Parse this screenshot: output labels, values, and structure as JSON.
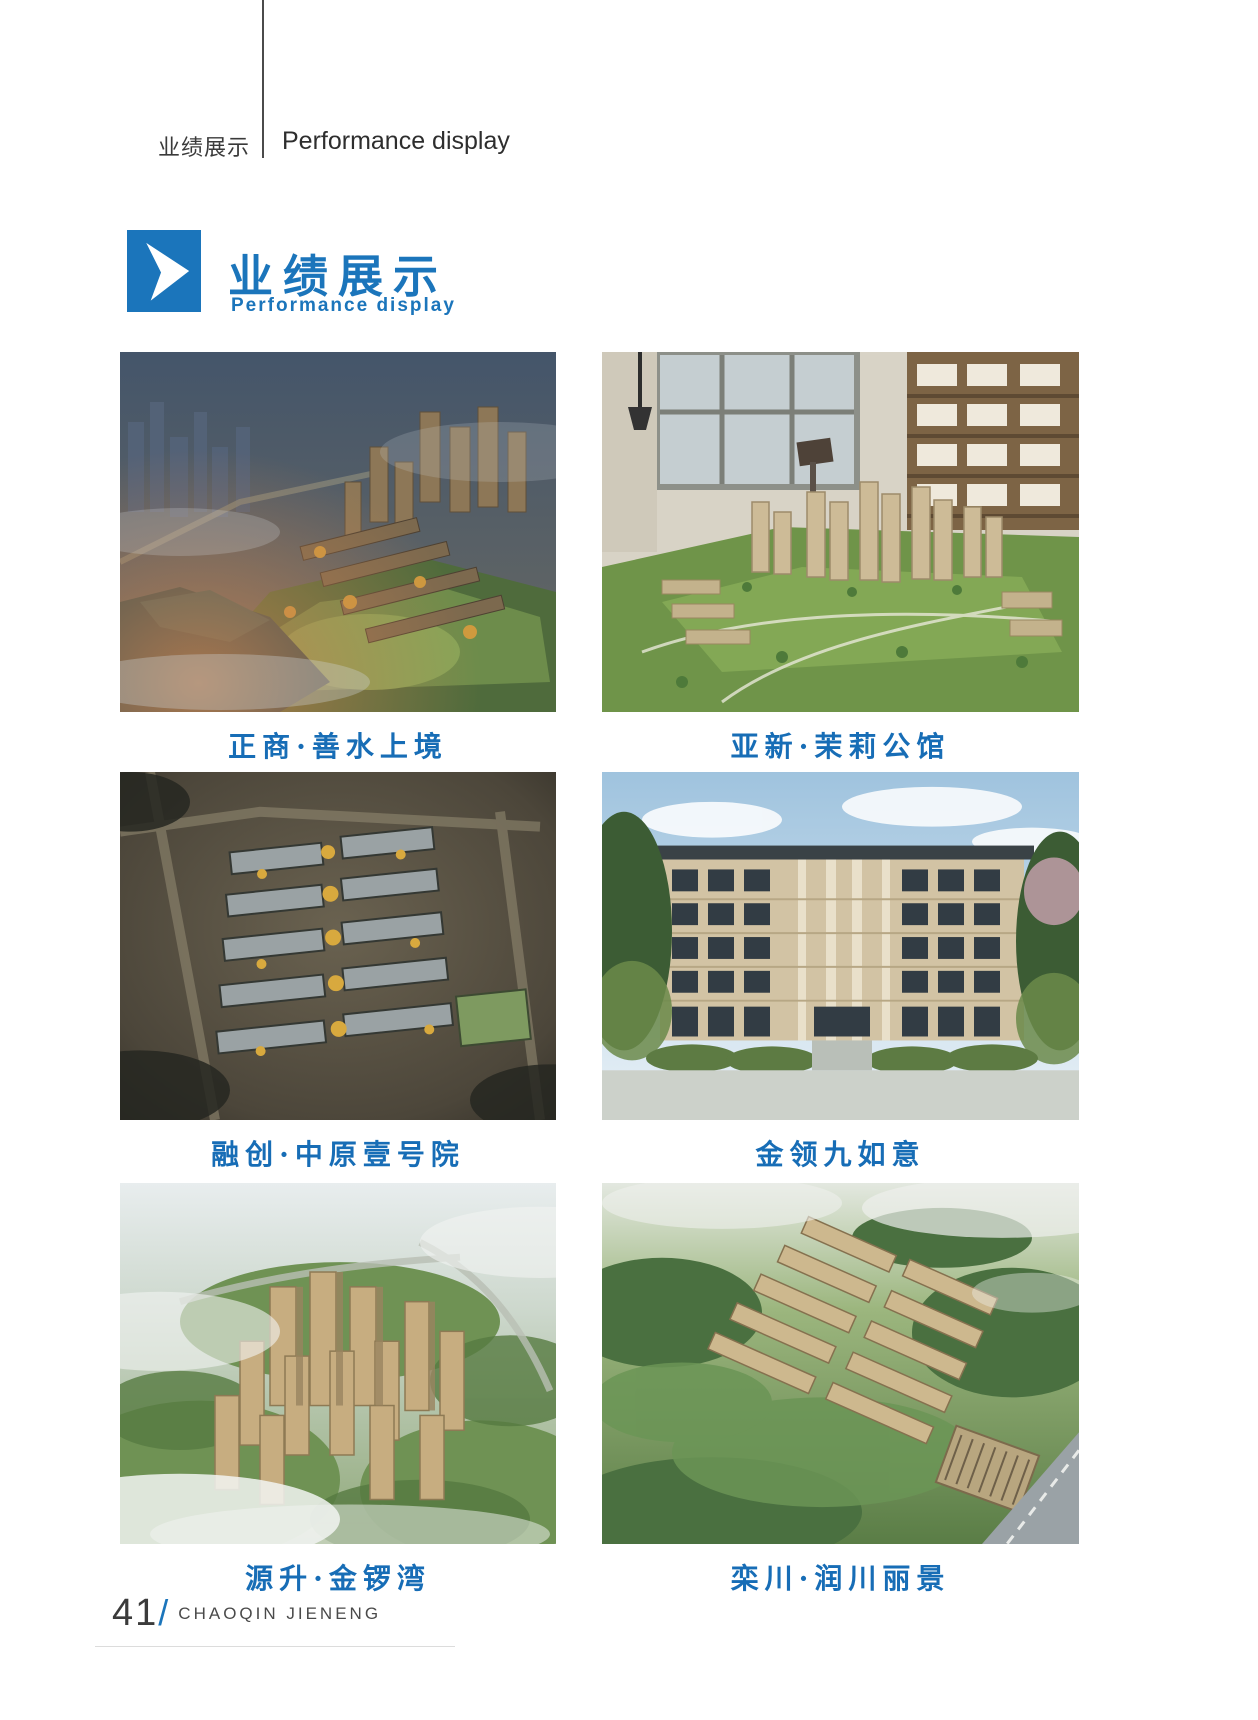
{
  "meta": {
    "accent_color": "#1b75bb",
    "caption_color": "#176db6"
  },
  "header": {
    "zh": "业绩展示",
    "en": "Performance display"
  },
  "section": {
    "title_zh": "业绩展示",
    "title_en": "Performance display",
    "marker_icon": "chevron-right-icon"
  },
  "projects": [
    {
      "caption": "正商·善水上境"
    },
    {
      "caption": "亚新·茉莉公馆"
    },
    {
      "caption": "融创·中原壹号院"
    },
    {
      "caption": "金领九如意"
    },
    {
      "caption": "源升·金锣湾"
    },
    {
      "caption": "栾川·润川丽景"
    }
  ],
  "footer": {
    "page_number": "41",
    "separator": "/",
    "company": "CHAOQIN JIENENG"
  }
}
